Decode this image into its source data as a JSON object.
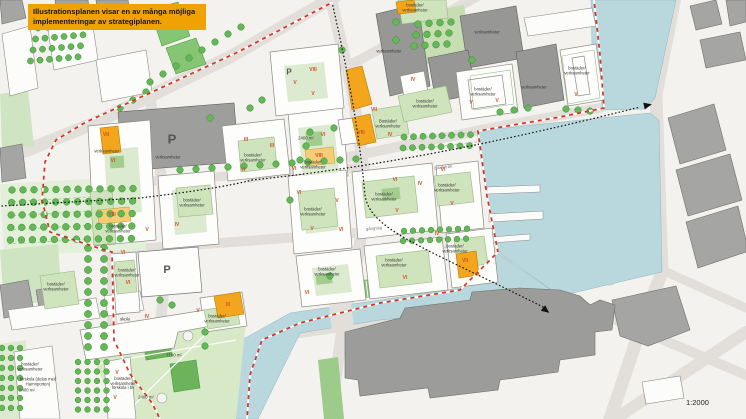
{
  "callout": {
    "text": "Illustrationsplanen visar en av många möjliga implementeringar av strategiplanen."
  },
  "scale": {
    "label": "1:2000"
  },
  "colors": {
    "water": "#b9d8dd",
    "accent_orange": "#f2a51d",
    "pale_yellow": "#f6cd77",
    "callout_bg": "#f0a202",
    "boundary_red": "#d63427",
    "numeral_red": "#d4502a",
    "park_green": "#cfe4c1",
    "building_green": "#cfe4bd",
    "tree_green": "#64b657",
    "context_gray": "#a5a5a3",
    "dark_building_gray": "#979795"
  },
  "map_labels": [
    {
      "text": "VII",
      "x": 106,
      "y": 136,
      "cls": "num"
    },
    {
      "text": "VI",
      "x": 113,
      "y": 162,
      "cls": "num"
    },
    {
      "text": "III",
      "x": 246,
      "y": 141,
      "cls": "num"
    },
    {
      "text": "VI",
      "x": 243,
      "y": 171,
      "cls": "num"
    },
    {
      "text": "III",
      "x": 272,
      "y": 147,
      "cls": "num"
    },
    {
      "text": "VIII",
      "x": 313,
      "y": 71,
      "cls": "num"
    },
    {
      "text": "V",
      "x": 295,
      "y": 84,
      "cls": "num"
    },
    {
      "text": "V",
      "x": 313,
      "y": 95,
      "cls": "num"
    },
    {
      "text": "VII",
      "x": 374,
      "y": 111,
      "cls": "num"
    },
    {
      "text": "VIII",
      "x": 361,
      "y": 134,
      "cls": "num"
    },
    {
      "text": "IV",
      "x": 390,
      "y": 136,
      "cls": "num"
    },
    {
      "text": "IV",
      "x": 413,
      "y": 81,
      "cls": "num"
    },
    {
      "text": "VI",
      "x": 323,
      "y": 136,
      "cls": "num"
    },
    {
      "text": "VIII",
      "x": 319,
      "y": 157,
      "cls": "num"
    },
    {
      "text": "VI",
      "x": 294,
      "y": 170,
      "cls": "num"
    },
    {
      "text": "VI",
      "x": 299,
      "y": 194,
      "cls": "num"
    },
    {
      "text": "V",
      "x": 312,
      "y": 230,
      "cls": "num"
    },
    {
      "text": "VI",
      "x": 341,
      "y": 231,
      "cls": "num"
    },
    {
      "text": "V",
      "x": 337,
      "y": 202,
      "cls": "num"
    },
    {
      "text": "VI",
      "x": 395,
      "y": 181,
      "cls": "num"
    },
    {
      "text": "IV",
      "x": 420,
      "y": 185,
      "cls": "num"
    },
    {
      "text": "V",
      "x": 397,
      "y": 212,
      "cls": "num"
    },
    {
      "text": "V",
      "x": 452,
      "y": 205,
      "cls": "num"
    },
    {
      "text": "VI",
      "x": 443,
      "y": 171,
      "cls": "num"
    },
    {
      "text": "IV",
      "x": 437,
      "y": 235,
      "cls": "num"
    },
    {
      "text": "VII",
      "x": 465,
      "y": 262,
      "cls": "num"
    },
    {
      "text": "VI",
      "x": 405,
      "y": 279,
      "cls": "num"
    },
    {
      "text": "VI",
      "x": 307,
      "y": 294,
      "cls": "num"
    },
    {
      "text": "V",
      "x": 471,
      "y": 104,
      "cls": "num"
    },
    {
      "text": "V",
      "x": 497,
      "y": 102,
      "cls": "num"
    },
    {
      "text": "V",
      "x": 576,
      "y": 96,
      "cls": "num"
    },
    {
      "text": "IV",
      "x": 147,
      "y": 318,
      "cls": "num"
    },
    {
      "text": "V",
      "x": 198,
      "y": 312,
      "cls": "num"
    },
    {
      "text": "XI",
      "x": 228,
      "y": 306,
      "cls": "num"
    },
    {
      "text": "V",
      "x": 117,
      "y": 374,
      "cls": "num"
    },
    {
      "text": "V",
      "x": 115,
      "y": 399,
      "cls": "num"
    },
    {
      "text": "VI",
      "x": 123,
      "y": 254,
      "cls": "num"
    },
    {
      "text": "VIII",
      "x": 112,
      "y": 216,
      "cls": "num"
    },
    {
      "text": "V",
      "x": 147,
      "y": 231,
      "cls": "num"
    },
    {
      "text": "IV",
      "x": 177,
      "y": 226,
      "cls": "num"
    },
    {
      "text": "VI",
      "x": 128,
      "y": 284,
      "cls": "num"
    },
    {
      "text": "bostäder/\nverksamheter",
      "x": 192,
      "y": 203,
      "cls": "txt"
    },
    {
      "text": "bostäder/\nverksamheter",
      "x": 118,
      "y": 229,
      "cls": "txt"
    },
    {
      "text": "bostäder/\nverksamheter",
      "x": 253,
      "y": 158,
      "cls": "txt"
    },
    {
      "text": "Bostäder/\nverksamheter",
      "x": 388,
      "y": 124,
      "cls": "txt"
    },
    {
      "text": "bostäder/\nverksamheter",
      "x": 425,
      "y": 104,
      "cls": "txt"
    },
    {
      "text": "bostäder/\nverksamheter",
      "x": 313,
      "y": 165,
      "cls": "txt"
    },
    {
      "text": "bostäder/\nverksamheter",
      "x": 415,
      "y": 8,
      "cls": "txt"
    },
    {
      "text": "verksamheter",
      "x": 487,
      "y": 33,
      "cls": "txt"
    },
    {
      "text": "verksamheter",
      "x": 534,
      "y": 88,
      "cls": "txt"
    },
    {
      "text": "bostäder/\nverksamheter",
      "x": 483,
      "y": 92,
      "cls": "txt"
    },
    {
      "text": "bostäder/\nverksamheter",
      "x": 577,
      "y": 71,
      "cls": "txt"
    },
    {
      "text": "bostäder/\nverksamheter",
      "x": 447,
      "y": 188,
      "cls": "txt"
    },
    {
      "text": "bostäder/\nverksamheter",
      "x": 313,
      "y": 212,
      "cls": "txt"
    },
    {
      "text": "bostäder/\nverksamheter",
      "x": 384,
      "y": 197,
      "cls": "txt"
    },
    {
      "text": "bostäder/\nverksamheter",
      "x": 327,
      "y": 272,
      "cls": "txt"
    },
    {
      "text": "bostäder/\nverksamheter",
      "x": 394,
      "y": 263,
      "cls": "txt"
    },
    {
      "text": "bostäder/\nverksamheter",
      "x": 455,
      "y": 249,
      "cls": "txt"
    },
    {
      "text": "bostäder/\nverksamheter",
      "x": 127,
      "y": 273,
      "cls": "txt"
    },
    {
      "text": "bostäder/\nverksamheter",
      "x": 56,
      "y": 287,
      "cls": "txt"
    },
    {
      "text": "bostäder/\nverksamheter",
      "x": 217,
      "y": 319,
      "cls": "txt"
    },
    {
      "text": "skola",
      "x": 125,
      "y": 320,
      "cls": "txt"
    },
    {
      "text": "verksamheter",
      "x": 168,
      "y": 158,
      "cls": "txt"
    },
    {
      "text": "verksamheter",
      "x": 107,
      "y": 152,
      "cls": "txt"
    },
    {
      "text": "verksamheter",
      "x": 389,
      "y": 52,
      "cls": "txt"
    },
    {
      "text": "bostäder/\nverksamheter",
      "x": 30,
      "y": 367,
      "cls": "txt"
    },
    {
      "text": "bostäder/\nverksamheter\nförskola i bv",
      "x": 123,
      "y": 384,
      "cls": "txt"
    },
    {
      "text": "förskola (delas med\nHamnporten)",
      "x": 38,
      "y": 382,
      "cls": "txt"
    },
    {
      "text": "2400 m²",
      "x": 27,
      "y": 391,
      "cls": "area"
    },
    {
      "text": "7100 m²",
      "x": 174,
      "y": 356,
      "cls": "area"
    },
    {
      "text": "2400 m²",
      "x": 146,
      "y": 398,
      "cls": "area"
    },
    {
      "text": "2400 m²",
      "x": 306,
      "y": 139,
      "cls": "area"
    },
    {
      "text": "P",
      "x": 172,
      "y": 140,
      "cls": "pbig"
    },
    {
      "text": "P",
      "x": 167,
      "y": 270,
      "cls": "pmed"
    },
    {
      "text": "P",
      "x": 289,
      "y": 73,
      "cls": "psml"
    },
    {
      "text": "cykelstråk",
      "x": 443,
      "y": 168,
      "cls": "street",
      "rot": -7
    },
    {
      "text": "gångväg",
      "x": 374,
      "y": 229,
      "cls": "street",
      "rot": -5
    }
  ]
}
